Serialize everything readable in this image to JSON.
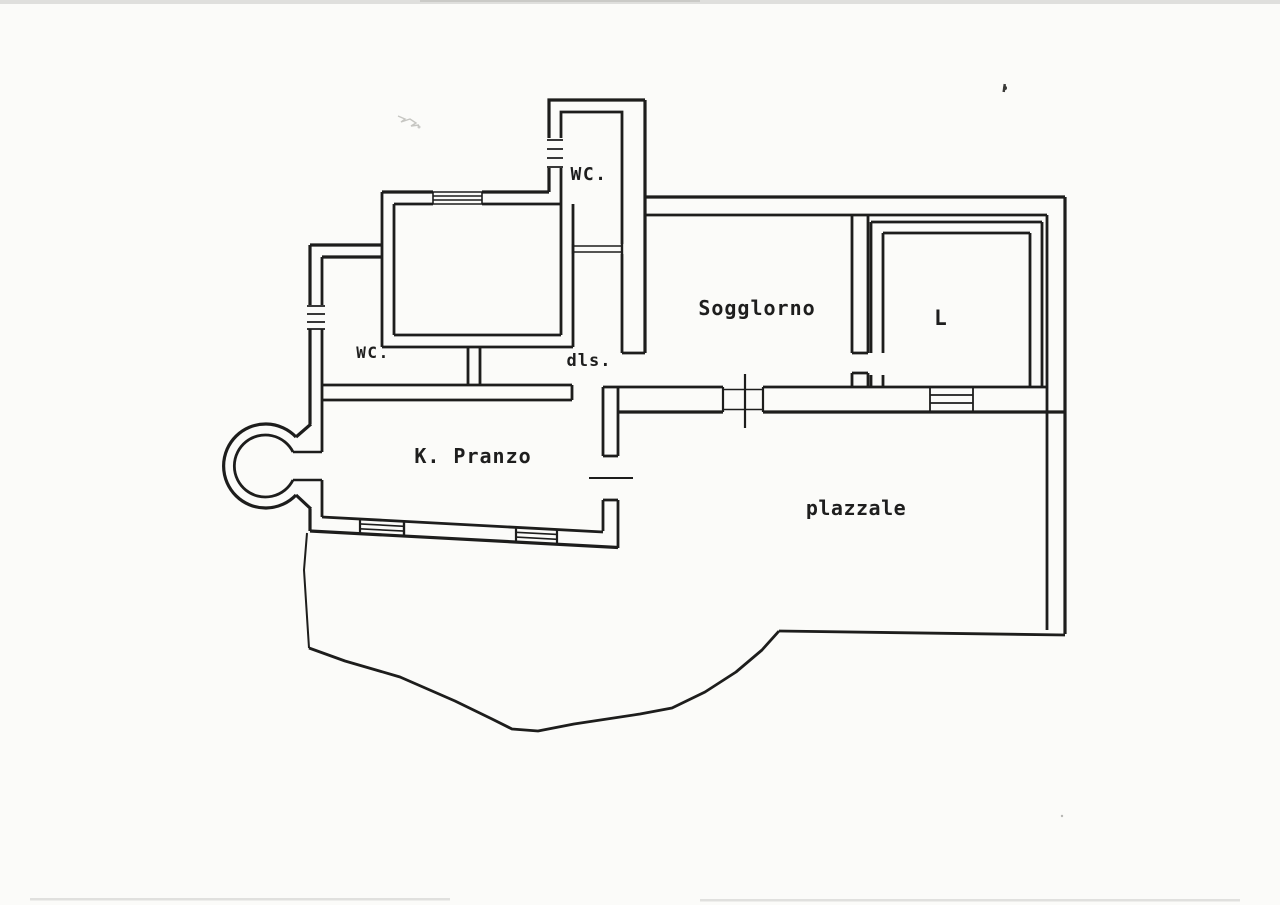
{
  "document": {
    "kind": "scanned floor plan drawing",
    "colors": {
      "paper": "#fbfbf9",
      "ink": "#1d1d1c",
      "pencil_smudge": "#9a9a96"
    }
  },
  "floor_plan": {
    "rooms": {
      "wc_top": "WC.",
      "soggiorno": "Sogglorno",
      "l_room": "L",
      "wc_left": "WC.",
      "hallway": "dls.",
      "kitchen_dining": "K. Pranzo",
      "courtyard": "plazzale"
    }
  }
}
